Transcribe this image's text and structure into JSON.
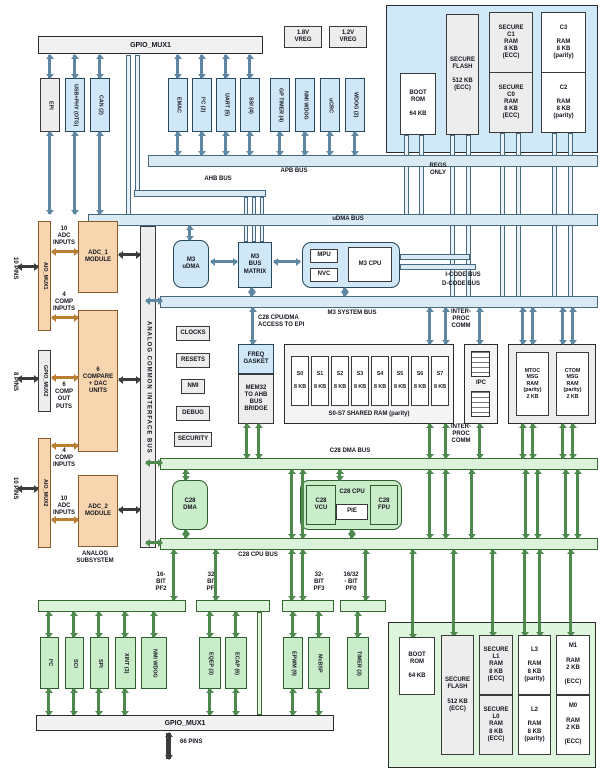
{
  "top_bar": "GPIO_MUX1",
  "vregs": {
    "v18": "1.8V\nVREG",
    "v12": "1.2V\nVREG"
  },
  "top_peripherals": [
    "EPI",
    "USB+PHY (OTG)",
    "CAN (2)",
    "EMAC",
    "I²C (2)",
    "UART (5)",
    "SSI (4)",
    "GP TIMER (4)",
    "NMI WDOG",
    "uCRC",
    "WDOG (2)"
  ],
  "m3_memory": {
    "boot_rom": "BOOT\nROM\n\n64 KB",
    "secure_flash": "SECURE\nFLASH\n\n512 KB\n(ECC)",
    "secure_c1": "SECURE\nC1\nRAM\n8 KB\n(ECC)",
    "secure_c0": "SECURE\nC0\nRAM\n8 KB\n(ECC)",
    "c3": "C3\n\nRAM\n8 KB\n(parity)",
    "c2": "C2\n\nRAM\n8 KB\n(parity)"
  },
  "buses": {
    "ahb": "AHB BUS",
    "apb": "APB BUS",
    "udma": "uDMA BUS",
    "regs_only": "REGS\nONLY",
    "m3_system": "M3 SYSTEM BUS",
    "icode": "I-CODE BUS",
    "dcode": "D-CODE BUS",
    "c28_access": "C28 CPU/DMA\nACCESS TO EPI",
    "c28_dma": "C28 DMA BUS",
    "c28_cpu": "C28 CPU BUS",
    "interproc": "INTER-\nPROC\nCOMM"
  },
  "m3_core": {
    "udma": "M3\nuDMA",
    "bus_matrix": "M3\nBUS\nMATRIX",
    "mpu": "MPU",
    "nvc": "NVC",
    "cpu": "M3 CPU"
  },
  "analog": {
    "aio_mux1": "AIO_MUX1",
    "aio_mux2": "AIO_MUX2",
    "gpio_mux2": "GPIO_MUX2",
    "pins10": "10 PINS",
    "pins8": "8 PINS",
    "adc_inputs": "10\nADC\nINPUTS",
    "comp_inputs": "4\nCOMP\nINPUTS",
    "comp_outputs": "6\nCOMP\nOUT\nPUTS",
    "adc1": "ADC_1\nMODULE",
    "adc2": "ADC_2\nMODULE",
    "compare": "6\nCOMPARE\n+ DAC\nUNITS",
    "subsystem": "ANALOG\nSUBSYSTEM",
    "acib": "ANALOG COMMON INTERFACE BUS"
  },
  "control": {
    "clocks": "CLOCKS",
    "resets": "RESETS",
    "nmi": "NMI",
    "debug": "DEBUG",
    "security": "SECURITY"
  },
  "bridge": {
    "freq": "FREQ\nGASKET",
    "mem32": "MEM32\nTO AHB\nBUS\nBRIDGE"
  },
  "shared_ram": {
    "cells": [
      "S0\n\n8 KB",
      "S1\n\n8 KB",
      "S2\n\n8 KB",
      "S3\n\n8 KB",
      "S4\n\n8 KB",
      "S5\n\n8 KB",
      "S6\n\n8 KB",
      "S7\n\n8 KB"
    ],
    "caption": "S0-S7 SHARED RAM (parity)"
  },
  "ipc_label": "IPC",
  "msg_ram": {
    "mtoc": "MTOC\nMSG\nRAM\n(parity)\n2 KB",
    "ctom": "CTOM\nMSG\nRAM\n(parity)\n2 KB"
  },
  "c28_core": {
    "dma": "C28\nDMA",
    "vcu": "C28\nVCU",
    "cpu": "C28 CPU",
    "pie": "PIE",
    "fpu": "C28\nFPU"
  },
  "pin_frames": [
    "16-\nBIT\nPF2",
    "32-\nBIT\nPF1",
    "32-\nBIT\nPF3",
    "16/32\n- BIT\nPF0"
  ],
  "bottom_peripherals": [
    "I²C",
    "SCI",
    "SPI",
    "XINT (3)",
    "NMI WDOG",
    "EQEP (3)",
    "ECAP (6)",
    "EPWM (9)",
    "McBSP",
    "TIMER (3)"
  ],
  "bottom_bar": {
    "label": "GPIO_MUX1",
    "pins66": "66 PINS"
  },
  "c28_memory": {
    "boot_rom": "BOOT\nROM\n\n64 KB",
    "secure_flash": "SECURE\nFLASH\n\n512 KB\n(ECC)",
    "secure_l1": "SECURE\nL1\nRAM\n8 KB\n(ECC)",
    "secure_l0": "SECURE\nL0\nRAM\n8 KB\n(ECC)",
    "l3": "L3\n\nRAM\n8 KB\n(parity)",
    "l2": "L2\n\nRAM\n8 KB\n(parity)",
    "m1": "M1\n\nRAM\n2 KB\n\n(ECC)",
    "m0": "M0\n\nRAM\n2 KB\n\n(ECC)"
  },
  "colors": {
    "m3_fill": "#cfe7f6",
    "c28_fill": "#c9ecc9",
    "analog_fill": "#f7d6af",
    "bus_blue": "#d9eaf4",
    "bus_green": "#dbf2db"
  }
}
